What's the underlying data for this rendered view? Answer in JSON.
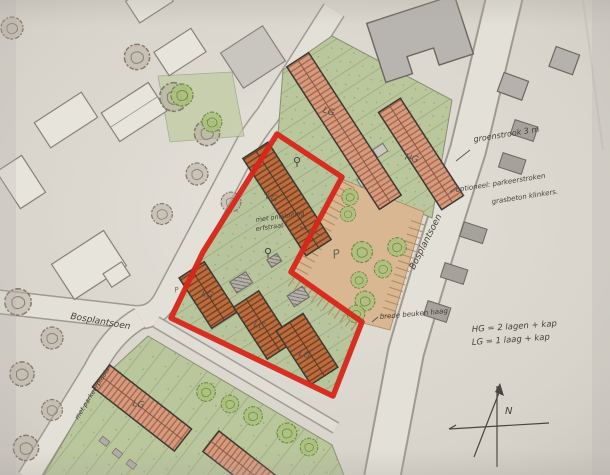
{
  "document": {
    "kind": "hand-drawn site plan sketch",
    "language": "nl"
  },
  "streets": {
    "left_road": "Bosplantsoen",
    "right_road": "Bosplantsoen"
  },
  "annotations": {
    "green_strip": "groenstrook 3 m",
    "optional_line1": "optioneel: parkeerstroken",
    "optional_line2": "grasbeton klinkers.",
    "hedge": "brede beuken haag",
    "access_line1": "met ontsluiting",
    "access_line2": "erfstraat !",
    "side_parking": "met parkeerplaats"
  },
  "legend": {
    "line1": "HG = 2 lagen + kap",
    "line2": "LG = 1 laag + kap"
  },
  "buildings": [
    {
      "id": "row-north-west",
      "label": "LG"
    },
    {
      "id": "row-north-east",
      "label": "HG"
    },
    {
      "id": "erf-row",
      "label": "LG"
    },
    {
      "id": "court-row-west",
      "label": "LG"
    },
    {
      "id": "court-row-mid",
      "label": "LG"
    },
    {
      "id": "court-row-south",
      "label": "LG"
    },
    {
      "id": "row-south-west",
      "label": "LG"
    }
  ],
  "symbols": {
    "north": "N",
    "parking": "P",
    "parking_small": "P"
  },
  "palette": {
    "red_boundary": "#d7261a",
    "lawn": "#bac69b",
    "roof_salmon": "#d69a7f",
    "roof_orange": "#bd6c3c",
    "courtyard": "#d9b793",
    "paper": "#d6d2ca",
    "tree_green": "#aac17b",
    "pencil": "#6e6960"
  }
}
